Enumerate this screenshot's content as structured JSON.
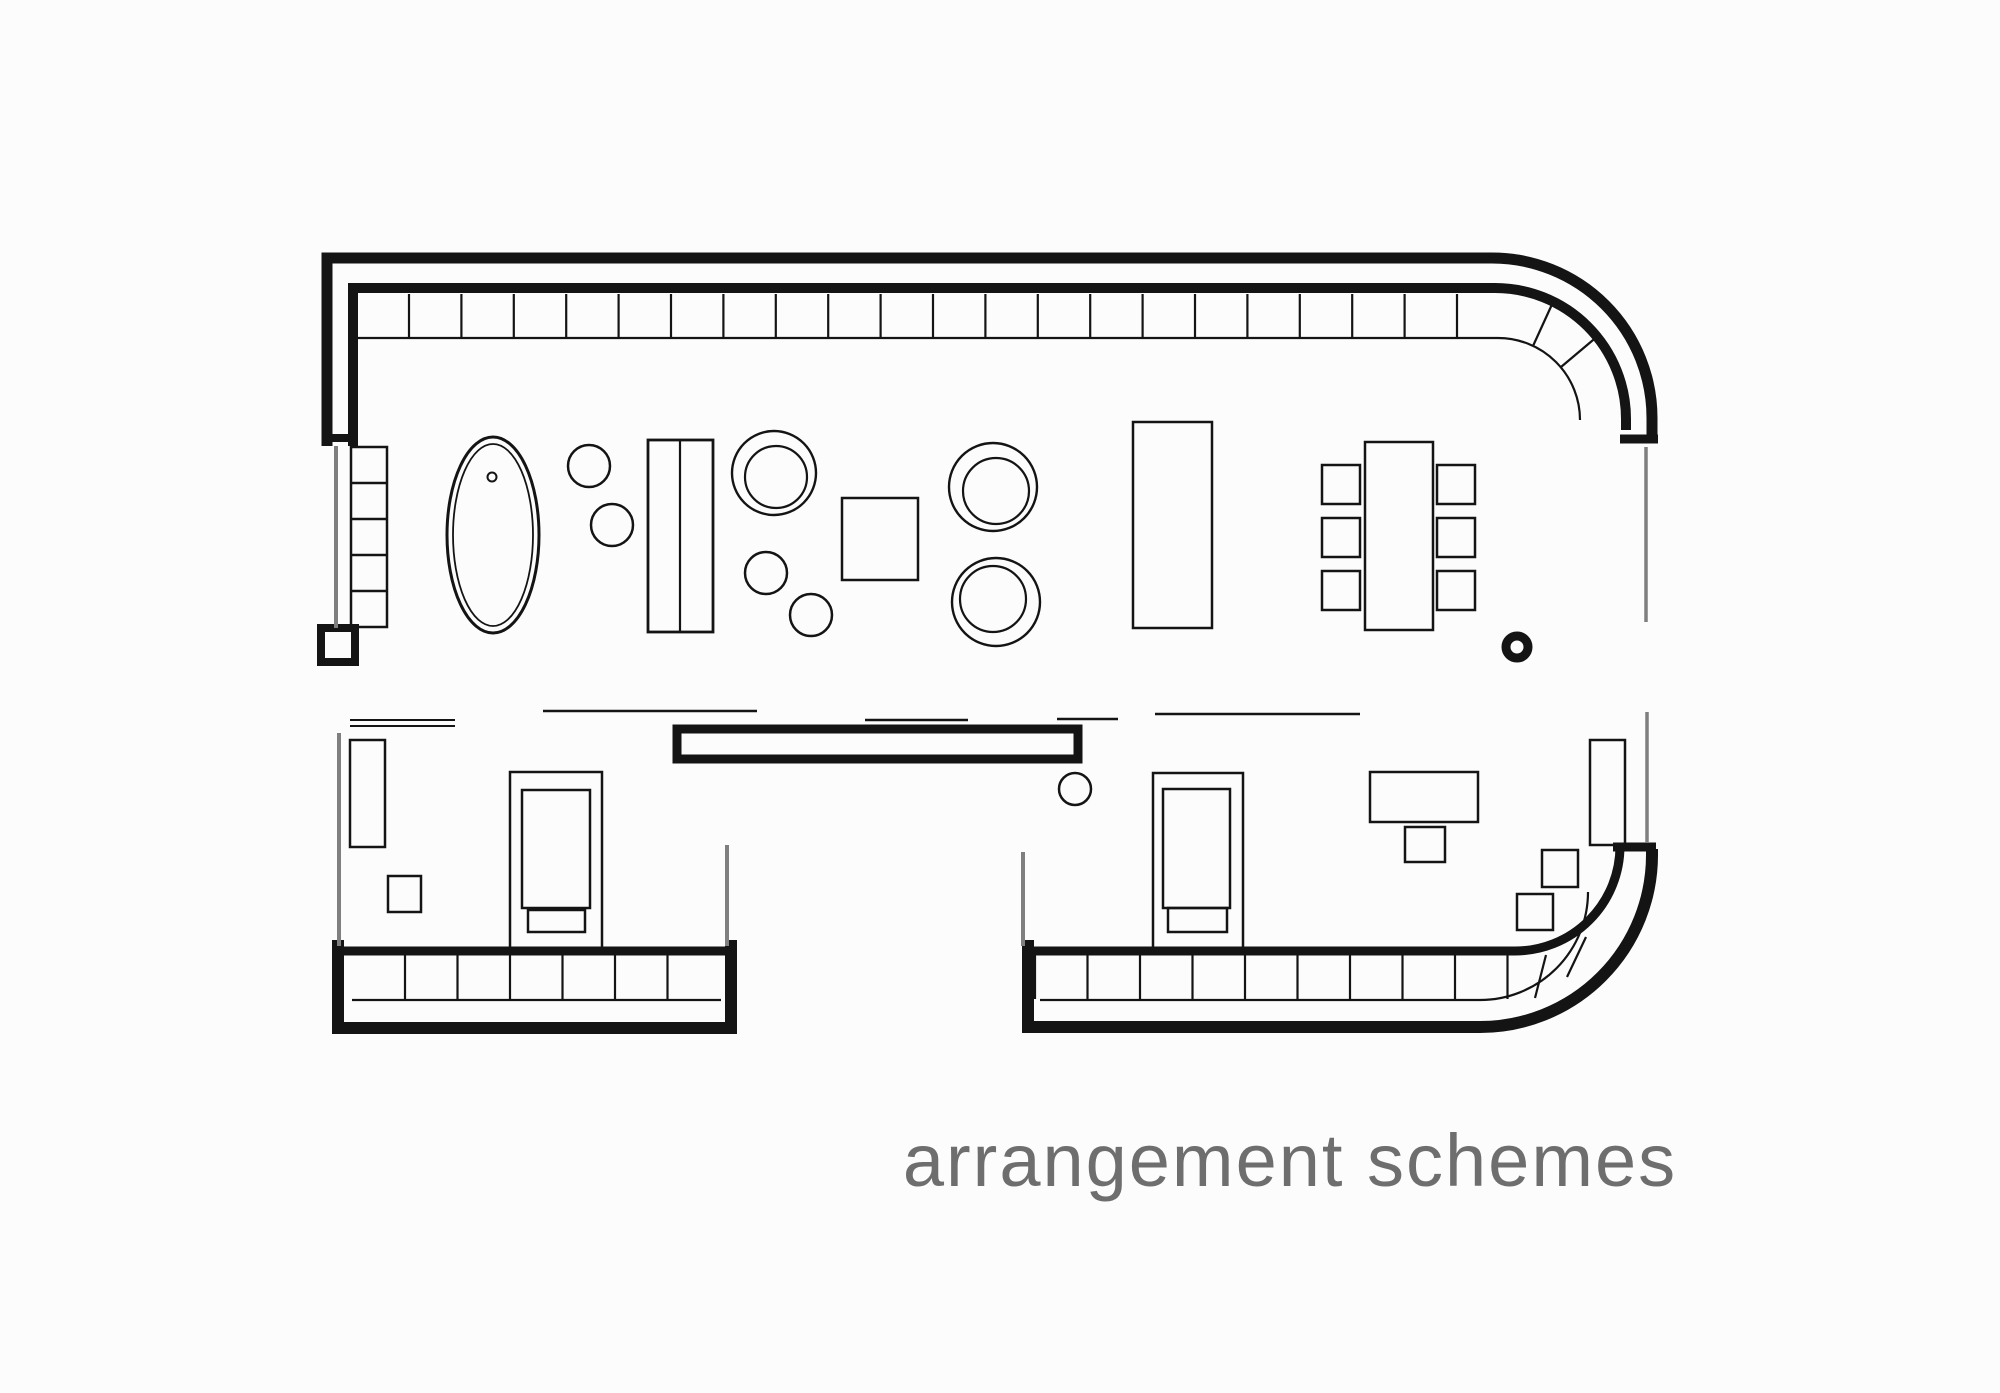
{
  "canvas": {
    "width": 2000,
    "height": 1393,
    "background": "#fcfcfc",
    "ink": "#141414",
    "gray": "#7f7f7f"
  },
  "caption": {
    "text": "arrangement schemes",
    "color": "#6e6e6e"
  },
  "plan": {
    "walls": [
      {
        "name": "wall-top-outer",
        "kind": "path",
        "d": "M 327,446 L 327,258 L 1492,258 A 160 160 0 0 1 1652,418 L 1652,441",
        "sw": 11
      },
      {
        "name": "wall-top-inner",
        "kind": "path",
        "d": "M 353,446 L 353,288 L 1495,288 A 131 131 0 0 1 1626,419 L 1626,430",
        "sw": 10
      },
      {
        "name": "wall-topright-end-cap",
        "kind": "line",
        "x1": 1620,
        "y1": 439,
        "x2": 1658,
        "y2": 439,
        "sw": 9
      },
      {
        "name": "wall-left-end-cap",
        "kind": "line",
        "x1": 322,
        "y1": 438,
        "x2": 358,
        "y2": 438,
        "sw": 8
      },
      {
        "name": "wall-left-end-post",
        "kind": "rect",
        "x": 321,
        "y": 628,
        "w": 34,
        "h": 34,
        "sw": 8
      },
      {
        "name": "wall-mid-partition",
        "kind": "rect",
        "x": 677,
        "y": 729,
        "w": 401,
        "h": 30,
        "sw": 9
      },
      {
        "name": "wall-bottomleft-outer",
        "kind": "path",
        "d": "M 338,940 L 338,1028 L 731,1028 L 731,940",
        "sw": 12
      },
      {
        "name": "wall-bottomleft-inner",
        "kind": "line",
        "x1": 333,
        "y1": 951,
        "x2": 737,
        "y2": 951,
        "sw": 9
      },
      {
        "name": "wall-bottomright-outer",
        "kind": "path",
        "d": "M 1028,940 L 1028,1027 L 1480,1027 A 172 172 0 0 0 1652,855 L 1652,849",
        "sw": 12
      },
      {
        "name": "wall-bottomright-inner",
        "kind": "path",
        "d": "M 1023,951 L 1515,951 A 105 105 0 0 0 1620,846",
        "sw": 9
      },
      {
        "name": "wall-bottomright-end-cap",
        "kind": "line",
        "x1": 1613,
        "y1": 847,
        "x2": 1656,
        "y2": 847,
        "sw": 9
      }
    ],
    "window_bands": [
      {
        "name": "band-top-sill",
        "kind": "path",
        "d": "M 352,338 L 1498,338 A 82 82 0 0 1 1580,420",
        "sw": 2.2
      },
      {
        "name": "band-top-mullions",
        "kind": "vlines",
        "start": 409,
        "step": 52.4,
        "count": 21,
        "y1": 294,
        "y2": 337,
        "sw": 2.2
      },
      {
        "name": "band-top-curve-tick-1",
        "kind": "line",
        "x1": 1533,
        "y1": 346,
        "x2": 1554,
        "y2": 300,
        "sw": 2.2
      },
      {
        "name": "band-top-curve-tick-2",
        "kind": "line",
        "x1": 1561,
        "y1": 367,
        "x2": 1599,
        "y2": 335,
        "sw": 2.2
      },
      {
        "name": "band-bottomleft-sill",
        "kind": "line",
        "x1": 352,
        "y1": 1000,
        "x2": 721,
        "y2": 1000,
        "sw": 2.2
      },
      {
        "name": "band-bottomleft-mullions",
        "kind": "vlines",
        "start": 405,
        "step": 52.5,
        "count": 6,
        "y1": 955,
        "y2": 999,
        "sw": 2.2
      },
      {
        "name": "band-bottomright-sill",
        "kind": "path",
        "d": "M 1040,1000 L 1480,1000 A 108 108 0 0 0 1588,892",
        "sw": 2.2
      },
      {
        "name": "band-bottomright-mullions",
        "kind": "vlines",
        "start": 1035,
        "step": 52.5,
        "count": 10,
        "y1": 955,
        "y2": 999,
        "sw": 2.2
      },
      {
        "name": "band-br-curve-tick-1",
        "kind": "line",
        "x1": 1546,
        "y1": 955,
        "x2": 1535,
        "y2": 998,
        "sw": 2.2
      },
      {
        "name": "band-br-curve-tick-2",
        "kind": "line",
        "x1": 1586,
        "y1": 937,
        "x2": 1567,
        "y2": 977,
        "sw": 2.2
      }
    ],
    "partition_lines": [
      {
        "name": "gray-wall-left-upper",
        "kind": "line",
        "x1": 336,
        "y1": 446,
        "x2": 336,
        "y2": 628,
        "sw": 4,
        "color": "gray"
      },
      {
        "name": "gray-wall-right-upper",
        "kind": "line",
        "x1": 1646,
        "y1": 447,
        "x2": 1646,
        "y2": 622,
        "sw": 3.5,
        "color": "gray"
      },
      {
        "name": "gray-wall-bl-left",
        "kind": "line",
        "x1": 339,
        "y1": 733,
        "x2": 339,
        "y2": 946,
        "sw": 4,
        "color": "gray"
      },
      {
        "name": "gray-wall-bl-right",
        "kind": "line",
        "x1": 727,
        "y1": 845,
        "x2": 727,
        "y2": 946,
        "sw": 4,
        "color": "gray"
      },
      {
        "name": "gray-wall-br-left",
        "kind": "line",
        "x1": 1023,
        "y1": 852,
        "x2": 1023,
        "y2": 946,
        "sw": 4,
        "color": "gray"
      },
      {
        "name": "gray-wall-br-right",
        "kind": "line",
        "x1": 1647,
        "y1": 712,
        "x2": 1647,
        "y2": 843,
        "sw": 3.5,
        "color": "gray"
      }
    ],
    "opening_lines": [
      {
        "name": "opening-line-1a",
        "kind": "line",
        "x1": 350,
        "y1": 720,
        "x2": 455,
        "y2": 720,
        "sw": 2
      },
      {
        "name": "opening-line-1b",
        "kind": "line",
        "x1": 350,
        "y1": 726,
        "x2": 455,
        "y2": 726,
        "sw": 2
      },
      {
        "name": "opening-line-2",
        "kind": "line",
        "x1": 543,
        "y1": 711,
        "x2": 757,
        "y2": 711,
        "sw": 2.4
      },
      {
        "name": "opening-line-3",
        "kind": "line",
        "x1": 865,
        "y1": 720,
        "x2": 968,
        "y2": 720,
        "sw": 2.4
      },
      {
        "name": "opening-line-4",
        "kind": "line",
        "x1": 1057,
        "y1": 719,
        "x2": 1118,
        "y2": 719,
        "sw": 2.4
      },
      {
        "name": "opening-line-5",
        "kind": "line",
        "x1": 1155,
        "y1": 714,
        "x2": 1360,
        "y2": 714,
        "sw": 2.4
      }
    ],
    "furniture": [
      {
        "name": "shelf-unit-left",
        "kind": "rect",
        "x": 351,
        "y": 447,
        "w": 36,
        "h": 180,
        "sw": 2.5
      },
      {
        "name": "shelf-unit-dividers",
        "kind": "hlines",
        "ys": [
          483,
          519,
          555,
          591
        ],
        "x1": 351,
        "x2": 387,
        "sw": 2.5
      },
      {
        "name": "bathtub-outer",
        "kind": "ellipse",
        "cx": 493,
        "cy": 535,
        "rx": 46,
        "ry": 98,
        "sw": 3
      },
      {
        "name": "bathtub-inner",
        "kind": "ellipse",
        "cx": 493,
        "cy": 535,
        "rx": 40,
        "ry": 91,
        "sw": 1.8
      },
      {
        "name": "bathtub-drain",
        "kind": "circle",
        "cx": 492,
        "cy": 477,
        "r": 4.5,
        "sw": 2
      },
      {
        "name": "stool-1",
        "kind": "circle",
        "cx": 589,
        "cy": 466,
        "r": 21,
        "sw": 2.5
      },
      {
        "name": "stool-2",
        "kind": "circle",
        "cx": 612,
        "cy": 525,
        "r": 21,
        "sw": 2.5
      },
      {
        "name": "sofa-body",
        "kind": "rect",
        "x": 648,
        "y": 440,
        "w": 65,
        "h": 192,
        "sw": 2.8
      },
      {
        "name": "sofa-split",
        "kind": "line",
        "x1": 680,
        "y1": 440,
        "x2": 680,
        "y2": 632,
        "sw": 2.2
      },
      {
        "name": "armchair-1-outer",
        "kind": "circle",
        "cx": 774,
        "cy": 473,
        "r": 42,
        "sw": 2.4
      },
      {
        "name": "armchair-1-inner",
        "kind": "circle",
        "cx": 776,
        "cy": 477,
        "r": 31,
        "sw": 2.2
      },
      {
        "name": "stool-3",
        "kind": "circle",
        "cx": 766,
        "cy": 573,
        "r": 21,
        "sw": 2.5
      },
      {
        "name": "stool-4",
        "kind": "circle",
        "cx": 811,
        "cy": 615,
        "r": 21,
        "sw": 2.5
      },
      {
        "name": "coffee-table",
        "kind": "rect",
        "x": 842,
        "y": 498,
        "w": 76,
        "h": 82,
        "sw": 2.5
      },
      {
        "name": "armchair-2-outer",
        "kind": "circle",
        "cx": 993,
        "cy": 487,
        "r": 44,
        "sw": 2.4
      },
      {
        "name": "armchair-2-inner",
        "kind": "circle",
        "cx": 996,
        "cy": 491,
        "r": 33,
        "sw": 2.2
      },
      {
        "name": "armchair-3-outer",
        "kind": "circle",
        "cx": 996,
        "cy": 602,
        "r": 44,
        "sw": 2.4
      },
      {
        "name": "armchair-3-inner",
        "kind": "circle",
        "cx": 993,
        "cy": 599,
        "r": 33,
        "sw": 2.2
      },
      {
        "name": "kitchen-island",
        "kind": "rect",
        "x": 1133,
        "y": 422,
        "w": 79,
        "h": 206,
        "sw": 2.5
      },
      {
        "name": "dining-table",
        "kind": "rect",
        "x": 1365,
        "y": 442,
        "w": 68,
        "h": 188,
        "sw": 2.5
      },
      {
        "name": "dining-chair-l1",
        "kind": "rect",
        "x": 1322,
        "y": 465,
        "w": 38,
        "h": 39,
        "sw": 2.5
      },
      {
        "name": "dining-chair-l2",
        "kind": "rect",
        "x": 1322,
        "y": 518,
        "w": 38,
        "h": 39,
        "sw": 2.5
      },
      {
        "name": "dining-chair-l3",
        "kind": "rect",
        "x": 1322,
        "y": 571,
        "w": 38,
        "h": 39,
        "sw": 2.5
      },
      {
        "name": "dining-chair-r1",
        "kind": "rect",
        "x": 1437,
        "y": 465,
        "w": 38,
        "h": 39,
        "sw": 2.5
      },
      {
        "name": "dining-chair-r2",
        "kind": "rect",
        "x": 1437,
        "y": 518,
        "w": 38,
        "h": 39,
        "sw": 2.5
      },
      {
        "name": "dining-chair-r3",
        "kind": "rect",
        "x": 1437,
        "y": 571,
        "w": 38,
        "h": 39,
        "sw": 2.5
      },
      {
        "name": "column-ring",
        "kind": "circle",
        "cx": 1517,
        "cy": 647,
        "r": 11,
        "sw": 9
      },
      {
        "name": "bl-cabinet",
        "kind": "rect",
        "x": 350,
        "y": 740,
        "w": 35,
        "h": 107,
        "sw": 2.5
      },
      {
        "name": "bl-side-table",
        "kind": "rect",
        "x": 388,
        "y": 876,
        "w": 33,
        "h": 36,
        "sw": 2.5
      },
      {
        "name": "bed-1-frame",
        "kind": "rect",
        "x": 510,
        "y": 772,
        "w": 92,
        "h": 180,
        "sw": 2.5
      },
      {
        "name": "bed-1-mattress",
        "kind": "rect",
        "x": 522,
        "y": 790,
        "w": 68,
        "h": 118,
        "sw": 2.5
      },
      {
        "name": "bed-1-foot",
        "kind": "rect",
        "x": 528,
        "y": 910,
        "w": 57,
        "h": 22,
        "sw": 2.5
      },
      {
        "name": "br-stool",
        "kind": "circle",
        "cx": 1075,
        "cy": 789,
        "r": 16,
        "sw": 2.5
      },
      {
        "name": "bed-2-frame",
        "kind": "rect",
        "x": 1153,
        "y": 773,
        "w": 90,
        "h": 180,
        "sw": 2.5
      },
      {
        "name": "bed-2-mattress",
        "kind": "rect",
        "x": 1163,
        "y": 789,
        "w": 67,
        "h": 119,
        "sw": 2.5
      },
      {
        "name": "bed-2-foot",
        "kind": "rect",
        "x": 1168,
        "y": 908,
        "w": 59,
        "h": 24,
        "sw": 2.5
      },
      {
        "name": "desk",
        "kind": "rect",
        "x": 1370,
        "y": 772,
        "w": 108,
        "h": 50,
        "sw": 2.5
      },
      {
        "name": "desk-chair",
        "kind": "rect",
        "x": 1405,
        "y": 827,
        "w": 40,
        "h": 35,
        "sw": 2.5
      },
      {
        "name": "br-square-upper",
        "kind": "rect",
        "x": 1542,
        "y": 850,
        "w": 36,
        "h": 37,
        "sw": 2.5
      },
      {
        "name": "br-square-lower",
        "kind": "rect",
        "x": 1517,
        "y": 894,
        "w": 36,
        "h": 36,
        "sw": 2.5
      },
      {
        "name": "br-cabinet",
        "kind": "rect",
        "x": 1590,
        "y": 740,
        "w": 35,
        "h": 105,
        "sw": 2.5
      }
    ]
  }
}
